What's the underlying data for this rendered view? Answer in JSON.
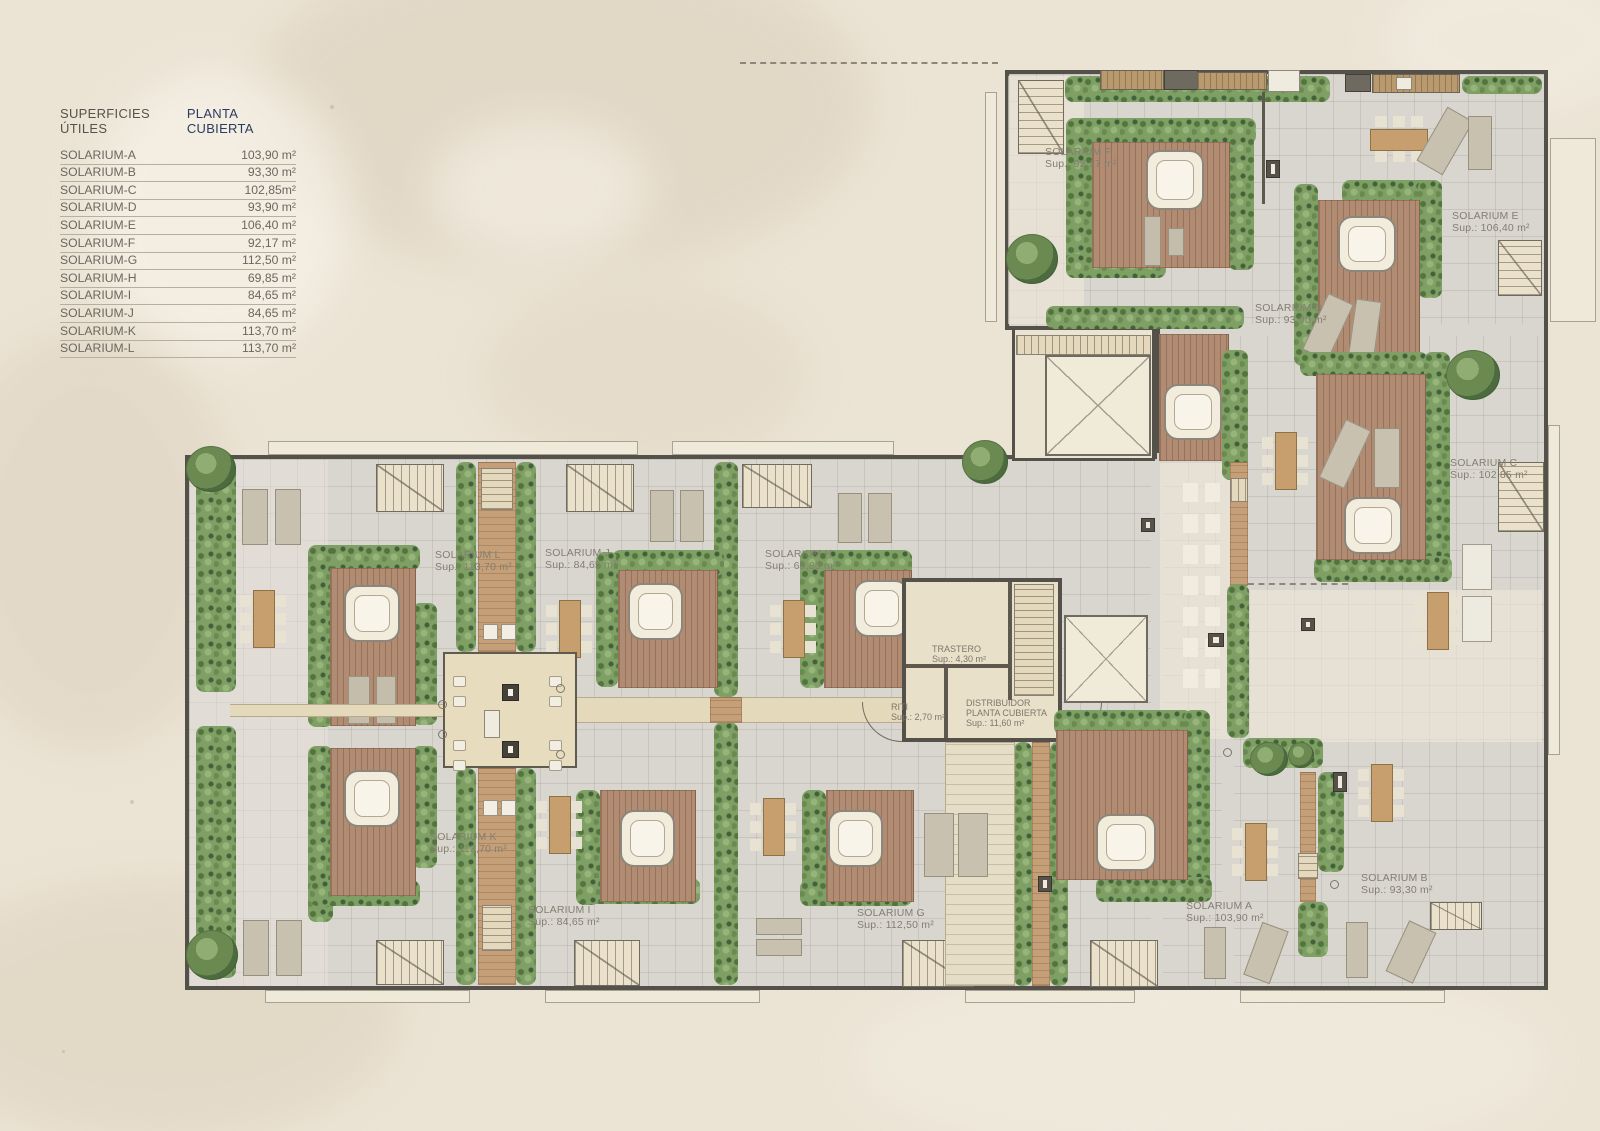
{
  "legend": {
    "title_left": "SUPERFICIES ÚTILES",
    "title_right": "PLANTA CUBIERTA",
    "rows": [
      {
        "name": "SOLARIUM-A",
        "value": "103,90 m²"
      },
      {
        "name": "SOLARIUM-B",
        "value": "93,30 m²"
      },
      {
        "name": "SOLARIUM-C",
        "value": "102,85m²"
      },
      {
        "name": "SOLARIUM-D",
        "value": "93,90 m²"
      },
      {
        "name": "SOLARIUM-E",
        "value": "106,40 m²"
      },
      {
        "name": "SOLARIUM-F",
        "value": "92,17 m²"
      },
      {
        "name": "SOLARIUM-G",
        "value": "112,50 m²"
      },
      {
        "name": "SOLARIUM-H",
        "value": "69,85 m²"
      },
      {
        "name": "SOLARIUM-I",
        "value": "84,65 m²"
      },
      {
        "name": "SOLARIUM-J",
        "value": "84,65 m²"
      },
      {
        "name": "SOLARIUM-K",
        "value": "113,70 m²"
      },
      {
        "name": "SOLARIUM-L",
        "value": "113,70 m²"
      }
    ]
  },
  "plan": {
    "labels": {
      "A": {
        "name": "SOLARIUM A",
        "sup": "Sup.: 103,90 m²"
      },
      "B": {
        "name": "SOLARIUM B",
        "sup": "Sup.: 93,30 m²"
      },
      "C": {
        "name": "SOLARIUM C",
        "sup": "Sup.: 102,85 m²"
      },
      "D": {
        "name": "SOLARIUM D",
        "sup": "Sup.: 93,90 m²"
      },
      "E": {
        "name": "SOLARIUM E",
        "sup": "Sup.: 106,40 m²"
      },
      "F": {
        "name": "SOLARIUM F",
        "sup": "Sup.: 92,17 m²"
      },
      "G": {
        "name": "SOLARIUM G",
        "sup": "Sup.: 112,50 m²"
      },
      "H": {
        "name": "SOLARIUM H",
        "sup": "Sup.: 69,85 m²"
      },
      "I": {
        "name": "SOLARIUM I",
        "sup": "Sup.: 84,65 m²"
      },
      "J": {
        "name": "SOLARIUM J",
        "sup": "Sup.: 84,65 m²"
      },
      "K": {
        "name": "SOLARIUM K",
        "sup": "Sup.: 113,70 m²"
      },
      "L": {
        "name": "SOLARIUM L",
        "sup": "Sup.: 113,70 m²"
      }
    },
    "rooms": {
      "trastero": {
        "name": "TRASTERO",
        "sup": "Sup.: 4,30 m²"
      },
      "riti": {
        "name": "RITI",
        "sup": "Sup.: 2,70 m²"
      },
      "distribuidor": {
        "name": "DISTRIBUIDOR",
        "line2": "PLANTA CUBIERTA",
        "sup": "Sup.: 11,60 m²"
      }
    }
  },
  "colors": {
    "wall": "#54504a",
    "tile_floor": "#d9d6d0",
    "hedge_green": "#7fa065",
    "deck_wood": "#b18c73",
    "walkway": "#e4d9bb",
    "legend_accent": "#2c3b60",
    "label_text": "#847e71",
    "background": "#ebe3d4"
  }
}
